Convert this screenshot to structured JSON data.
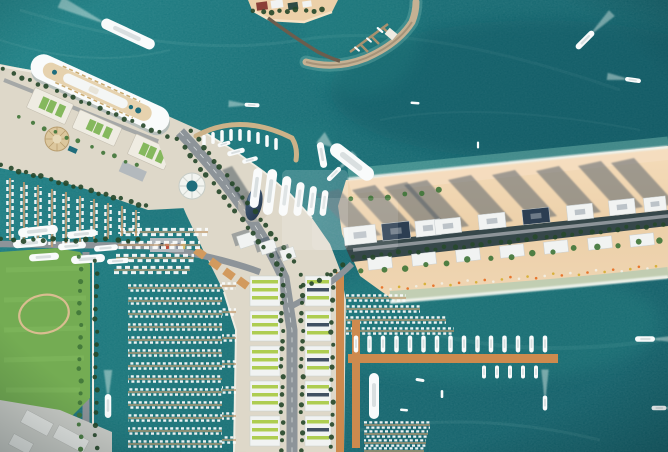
{
  "meta": {
    "title": "Aerial view of a harbour development with cruise terminal, marinas and beachfront towers",
    "type": "aerial-photograph"
  },
  "palette": {
    "water_deep": "#0a5a64",
    "water_mid": "#0e6870",
    "water_light": "#177e83",
    "water_pocket": "#23908c",
    "shallow": "#6fc2b2",
    "foam": "#eef3ec",
    "sand": "#ecd0a9",
    "sand_light": "#f5ddc0",
    "sand_wet": "#f3e2cb",
    "shadow_slate": "#4e5a66",
    "land_concrete": "#ded8c9",
    "concrete_bright": "#efece2",
    "road": "#8d9499",
    "road_line": "#e9ebea",
    "pier": "#c59a6d",
    "pier_orange": "#cd8a4e",
    "quay_tan": "#d3b084",
    "pavilion": "#d29a5e",
    "rock": "#c5b193",
    "green_dark": "#27492b",
    "green_mid": "#41763a",
    "green_roof": "#79b24f",
    "lawn": "#74ac53",
    "lawn_light": "#83ba60",
    "lime": "#a6c93f",
    "roof_white": "#f1f3f2",
    "roof_navy": "#2c3e52",
    "hull": "#f9fbfb",
    "deck": "#d9dfe0",
    "cream": "#e6d2ae",
    "wake": "#e6f2ec",
    "track": "#d9bd90",
    "industrial": "#cbcdc8",
    "teal_pool": "#1f6d7c"
  },
  "watermark": {
    "name": "translucent-logo-overlay",
    "opacity_primary": 0.17,
    "opacity_secondary": 0.11
  },
  "boats": {
    "moving": [
      {
        "x": 128,
        "y": 34,
        "l": 58,
        "w": 11,
        "a": 25,
        "wk": 46
      },
      {
        "x": 252,
        "y": 105,
        "l": 15,
        "w": 4,
        "a": 3,
        "wk": 16
      },
      {
        "x": 585,
        "y": 40,
        "l": 24,
        "w": 6,
        "a": 135,
        "wk": 26
      },
      {
        "x": 633,
        "y": 80,
        "l": 16,
        "w": 4.5,
        "a": 8,
        "wk": 18
      },
      {
        "x": 415,
        "y": 103,
        "l": 9,
        "w": 2.5,
        "a": 5,
        "wk": 0
      },
      {
        "x": 478,
        "y": 145,
        "l": 7,
        "w": 2.2,
        "a": 0,
        "wk": 0
      },
      {
        "x": 334,
        "y": 174,
        "l": 18,
        "w": 5,
        "a": 135,
        "wk": 20
      },
      {
        "x": 352,
        "y": 162,
        "l": 52,
        "w": 14,
        "a": 38,
        "wk": 14
      },
      {
        "x": 322,
        "y": 155,
        "l": 26,
        "w": 7,
        "a": 80,
        "wk": 0
      },
      {
        "x": 645,
        "y": 339,
        "l": 20,
        "w": 5.5,
        "a": 180,
        "wk": 24
      },
      {
        "x": 545,
        "y": 403,
        "l": 15,
        "w": 4.5,
        "a": 90,
        "wk": 26
      },
      {
        "x": 659,
        "y": 408,
        "l": 15,
        "w": 4.5,
        "a": 180,
        "wk": 14
      },
      {
        "x": 108,
        "y": 406,
        "l": 24,
        "w": 6.5,
        "a": 90,
        "wk": 24
      },
      {
        "x": 420,
        "y": 380,
        "l": 9,
        "w": 3,
        "a": 10,
        "wk": 0
      },
      {
        "x": 442,
        "y": 394,
        "l": 8,
        "w": 2.6,
        "a": 0,
        "wk": 0
      },
      {
        "x": 404,
        "y": 410,
        "l": 8,
        "w": 2.6,
        "a": 5,
        "wk": 0
      },
      {
        "x": 357,
        "y": 49,
        "l": 7,
        "w": 2,
        "a": 40,
        "wk": 0
      },
      {
        "x": 369,
        "y": 40,
        "l": 7,
        "w": 2,
        "a": 40,
        "wk": 0
      },
      {
        "x": 380,
        "y": 30,
        "l": 8,
        "w": 2.2,
        "a": 40,
        "wk": 0
      }
    ],
    "pocket_small": [
      {
        "x": 204,
        "y": 141
      },
      {
        "x": 213,
        "y": 138
      },
      {
        "x": 222,
        "y": 136
      },
      {
        "x": 231,
        "y": 135
      },
      {
        "x": 240,
        "y": 135
      },
      {
        "x": 249,
        "y": 136
      },
      {
        "x": 258,
        "y": 138
      },
      {
        "x": 267,
        "y": 141
      },
      {
        "x": 276,
        "y": 144
      }
    ],
    "pocket_yachts": [
      {
        "x": 256,
        "y": 188,
        "l": 40,
        "w": 9
      },
      {
        "x": 270,
        "y": 192,
        "l": 46,
        "w": 10
      },
      {
        "x": 285,
        "y": 196,
        "l": 40,
        "w": 9
      },
      {
        "x": 299,
        "y": 199,
        "l": 34,
        "w": 8
      },
      {
        "x": 312,
        "y": 201,
        "l": 30,
        "w": 7
      },
      {
        "x": 324,
        "y": 203,
        "l": 26,
        "w": 6.5
      }
    ],
    "pocket_horiz": [
      {
        "x": 236,
        "y": 152,
        "l": 18,
        "w": 5
      },
      {
        "x": 250,
        "y": 160,
        "l": 16,
        "w": 4.5
      },
      {
        "x": 224,
        "y": 144,
        "l": 13,
        "w": 4
      }
    ],
    "left_yachts": [
      {
        "x": 38,
        "y": 231,
        "l": 40,
        "a": -6
      },
      {
        "x": 82,
        "y": 234,
        "l": 30,
        "a": -6
      },
      {
        "x": 30,
        "y": 243,
        "l": 34,
        "a": -5
      },
      {
        "x": 72,
        "y": 246,
        "l": 28,
        "a": -5
      },
      {
        "x": 106,
        "y": 248,
        "l": 24,
        "a": -5
      },
      {
        "x": 44,
        "y": 257,
        "l": 30,
        "a": -4
      },
      {
        "x": 88,
        "y": 259,
        "l": 34,
        "a": -4
      },
      {
        "x": 118,
        "y": 261,
        "l": 22,
        "a": -4
      }
    ],
    "moored": [
      {
        "x": 374,
        "y": 396,
        "l": 46,
        "w": 10,
        "a": 90
      }
    ],
    "orange_row_top": {
      "x1": 356,
      "x2": 550,
      "step": 13.5,
      "y": 344,
      "l": 17,
      "w": 4.5
    },
    "orange_row_bottom": {
      "x1": 484,
      "x2": 540,
      "step": 13,
      "y": 372,
      "l": 13,
      "w": 4
    }
  },
  "piers": {
    "left_vertical": [
      {
        "x": 10,
        "yt": 178,
        "len": 62
      },
      {
        "x": 24,
        "yt": 182,
        "len": 62
      },
      {
        "x": 38,
        "yt": 185,
        "len": 60
      },
      {
        "x": 52,
        "yt": 189,
        "len": 58
      },
      {
        "x": 66,
        "yt": 192,
        "len": 56
      },
      {
        "x": 80,
        "yt": 196,
        "len": 52
      },
      {
        "x": 94,
        "yt": 199,
        "len": 40
      },
      {
        "x": 108,
        "yt": 203,
        "len": 36
      },
      {
        "x": 122,
        "yt": 206,
        "len": 30
      },
      {
        "x": 136,
        "yt": 210,
        "len": 26
      }
    ],
    "channel_upper": [
      [
        232,
        120,
        208
      ],
      [
        245,
        118,
        200
      ],
      [
        258,
        116,
        194
      ],
      [
        270,
        114,
        190
      ]
    ],
    "channel_dense": [
      [
        288,
        128,
        222
      ],
      [
        301,
        128,
        222
      ],
      [
        314,
        128,
        222
      ],
      [
        327,
        128,
        222
      ],
      [
        340,
        128,
        222
      ],
      [
        353,
        128,
        222
      ],
      [
        366,
        128,
        222
      ],
      [
        379,
        128,
        222
      ],
      [
        392,
        128,
        222
      ],
      [
        405,
        128,
        222
      ],
      [
        418,
        128,
        222
      ],
      [
        431,
        128,
        222
      ],
      [
        444,
        128,
        222
      ]
    ],
    "west_jetties": [
      [
        286,
        222,
        236
      ],
      [
        312,
        222,
        236
      ],
      [
        338,
        222,
        236
      ],
      [
        364,
        222,
        236
      ],
      [
        390,
        222,
        236
      ],
      [
        416,
        222,
        236
      ],
      [
        440,
        222,
        236
      ]
    ],
    "east_north": [
      [
        298,
        346,
        406
      ],
      [
        309,
        346,
        420
      ],
      [
        320,
        346,
        446
      ],
      [
        331,
        346,
        454
      ]
    ],
    "east_south": [
      [
        425,
        364,
        430
      ],
      [
        434,
        364,
        428
      ],
      [
        443,
        364,
        426
      ],
      [
        451,
        364,
        424
      ]
    ]
  },
  "trees": {
    "rows": [
      [
        4,
        70,
        168,
        136,
        9,
        2,
        "green_dark"
      ],
      [
        2,
        166,
        146,
        206,
        8,
        2.2,
        "green_dark"
      ],
      [
        20,
        118,
        138,
        166,
        12,
        1.8,
        "green_mid"
      ],
      [
        178,
        140,
        282,
        270,
        9,
        2.2,
        "green_dark"
      ],
      [
        192,
        132,
        294,
        262,
        9,
        2.2,
        "green_dark"
      ],
      [
        282,
        276,
        282,
        450,
        9,
        2,
        "green_dark"
      ],
      [
        302,
        276,
        302,
        450,
        9,
        2,
        "green_dark"
      ],
      [
        2,
        240,
        138,
        240,
        10,
        2.2,
        "green_dark"
      ],
      [
        80,
        258,
        80,
        448,
        11,
        2,
        "green_mid"
      ],
      [
        96,
        262,
        96,
        448,
        11,
        2,
        "green_dark"
      ],
      [
        354,
        258,
        664,
        224,
        9,
        2,
        "green_dark"
      ],
      [
        362,
        272,
        660,
        240,
        21,
        2.6,
        "green_mid"
      ],
      [
        254,
        12,
        322,
        10,
        8,
        2.2,
        "green_dark"
      ],
      [
        332,
        276,
        332,
        448,
        11,
        2,
        "green_dark"
      ],
      [
        302,
        288,
        344,
        266,
        8,
        2,
        "green_dark"
      ],
      [
        352,
        200,
        440,
        191,
        16,
        2.4,
        "green_mid"
      ]
    ]
  },
  "peninsula": {
    "shadow_points": [
      {
        "x": 360,
        "y": 235
      },
      {
        "x": 396,
        "y": 231
      },
      {
        "x": 428,
        "y": 228
      },
      {
        "x": 448,
        "y": 226
      },
      {
        "x": 492,
        "y": 221
      },
      {
        "x": 536,
        "y": 216
      },
      {
        "x": 580,
        "y": 212
      },
      {
        "x": 622,
        "y": 207
      },
      {
        "x": 655,
        "y": 204
      }
    ],
    "towers": [
      {
        "x": 360,
        "y": 235,
        "w": 32,
        "h": 18,
        "f": "roof_white"
      },
      {
        "x": 396,
        "y": 231,
        "w": 28,
        "h": 17,
        "f": "roof_navy"
      },
      {
        "x": 428,
        "y": 228,
        "w": 25,
        "h": 16,
        "f": "roof_white"
      },
      {
        "x": 448,
        "y": 226,
        "w": 26,
        "h": 15,
        "f": "roof_white"
      },
      {
        "x": 492,
        "y": 221,
        "w": 27,
        "h": 15,
        "f": "roof_white"
      },
      {
        "x": 536,
        "y": 216,
        "w": 27,
        "h": 15,
        "f": "roof_navy"
      },
      {
        "x": 580,
        "y": 212,
        "w": 26,
        "h": 15,
        "f": "roof_white"
      },
      {
        "x": 622,
        "y": 207,
        "w": 26,
        "h": 15,
        "f": "roof_white"
      },
      {
        "x": 655,
        "y": 204,
        "w": 22,
        "h": 14,
        "f": "roof_white"
      }
    ],
    "villas": [
      {
        "x": 380,
        "y": 263
      },
      {
        "x": 424,
        "y": 259
      },
      {
        "x": 468,
        "y": 255
      },
      {
        "x": 512,
        "y": 251
      },
      {
        "x": 556,
        "y": 247
      },
      {
        "x": 600,
        "y": 243
      },
      {
        "x": 642,
        "y": 240
      }
    ],
    "umbrellas": {
      "x1": 382,
      "y1": 289,
      "x2": 656,
      "y2": 267,
      "step": 8.5,
      "colors": [
        "#e8762d",
        "#f2ede0",
        "#d8b13c"
      ]
    }
  },
  "buildings": {
    "slab_ys": [
      276,
      311,
      346,
      381,
      416
    ],
    "slab_left_x": 250,
    "slab_right_x": 305,
    "midrise": [
      {
        "x": 247,
        "y": 240,
        "w": 18,
        "h": 13
      },
      {
        "x": 268,
        "y": 247,
        "w": 16,
        "h": 12
      },
      {
        "x": 288,
        "y": 254,
        "w": 14,
        "h": 11
      }
    ],
    "pavilions": [
      {
        "x": 200,
        "y": 253
      },
      {
        "x": 215,
        "y": 264
      },
      {
        "x": 229,
        "y": 274
      },
      {
        "x": 243,
        "y": 283
      }
    ],
    "terminal": [
      {
        "x": 50,
        "y": 106,
        "w": 42,
        "h": 22
      },
      {
        "x": 97,
        "y": 128,
        "w": 46,
        "h": 20
      },
      {
        "x": 150,
        "y": 152,
        "w": 40,
        "h": 22
      }
    ],
    "island": [
      {
        "x": 262,
        "y": 6,
        "w": 11,
        "h": 8,
        "f": "#8a4038"
      },
      {
        "x": 277,
        "y": 4,
        "w": 12,
        "h": 8,
        "f": "#f1f3f2"
      },
      {
        "x": 293,
        "y": 6,
        "w": 10,
        "h": 7,
        "f": "#2e4a44"
      },
      {
        "x": 307,
        "y": 4,
        "w": 9,
        "h": 6,
        "f": "#f1f3f2"
      }
    ],
    "sheds": [
      {
        "x": 22,
        "y": 416,
        "w": 30,
        "h": 14
      },
      {
        "x": 54,
        "y": 432,
        "w": 34,
        "h": 14
      },
      {
        "x": 10,
        "y": 438,
        "w": 22,
        "h": 12
      }
    ]
  },
  "cars": {
    "y": 243,
    "xs": [
      154,
      159.5,
      165,
      170.5,
      176,
      181.5
    ],
    "colors": [
      "#e8e8e8",
      "#3a4a5a",
      "#c05040",
      "#e8e8e8",
      "#8890a0",
      "#d8c070"
    ]
  }
}
